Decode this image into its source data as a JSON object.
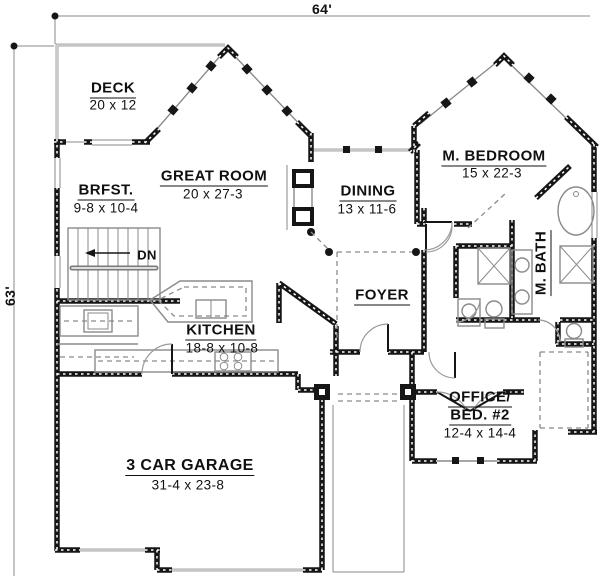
{
  "dimensions": {
    "width_label": "64'",
    "height_label": "63'"
  },
  "rooms": {
    "deck": {
      "name": "DECK",
      "size": "20 x 12"
    },
    "brfst": {
      "name": "BRFST.",
      "size": "9-8 x 10-4"
    },
    "great_room": {
      "name": "GREAT ROOM",
      "size": "20 x 27-3"
    },
    "dining": {
      "name": "DINING",
      "size": "13 x 11-6"
    },
    "m_bedroom": {
      "name": "M. BEDROOM",
      "size": "15 x 22-3"
    },
    "m_bath": {
      "name": "M. BATH"
    },
    "kitchen": {
      "name": "KITCHEN",
      "size": "18-8 x 10-8"
    },
    "foyer": {
      "name": "FOYER"
    },
    "office_bed2": {
      "name_line1": "OFFICE/",
      "name_line2": "BED. #2",
      "size": "12-4 x 14-4"
    },
    "garage": {
      "name": "3 CAR GARAGE",
      "size": "31-4 x 23-8"
    },
    "stairs": {
      "label": "DN"
    }
  },
  "colors": {
    "wall": "#161616",
    "thin_line": "#8a8a8a",
    "text": "#101010",
    "background": "#ffffff"
  }
}
